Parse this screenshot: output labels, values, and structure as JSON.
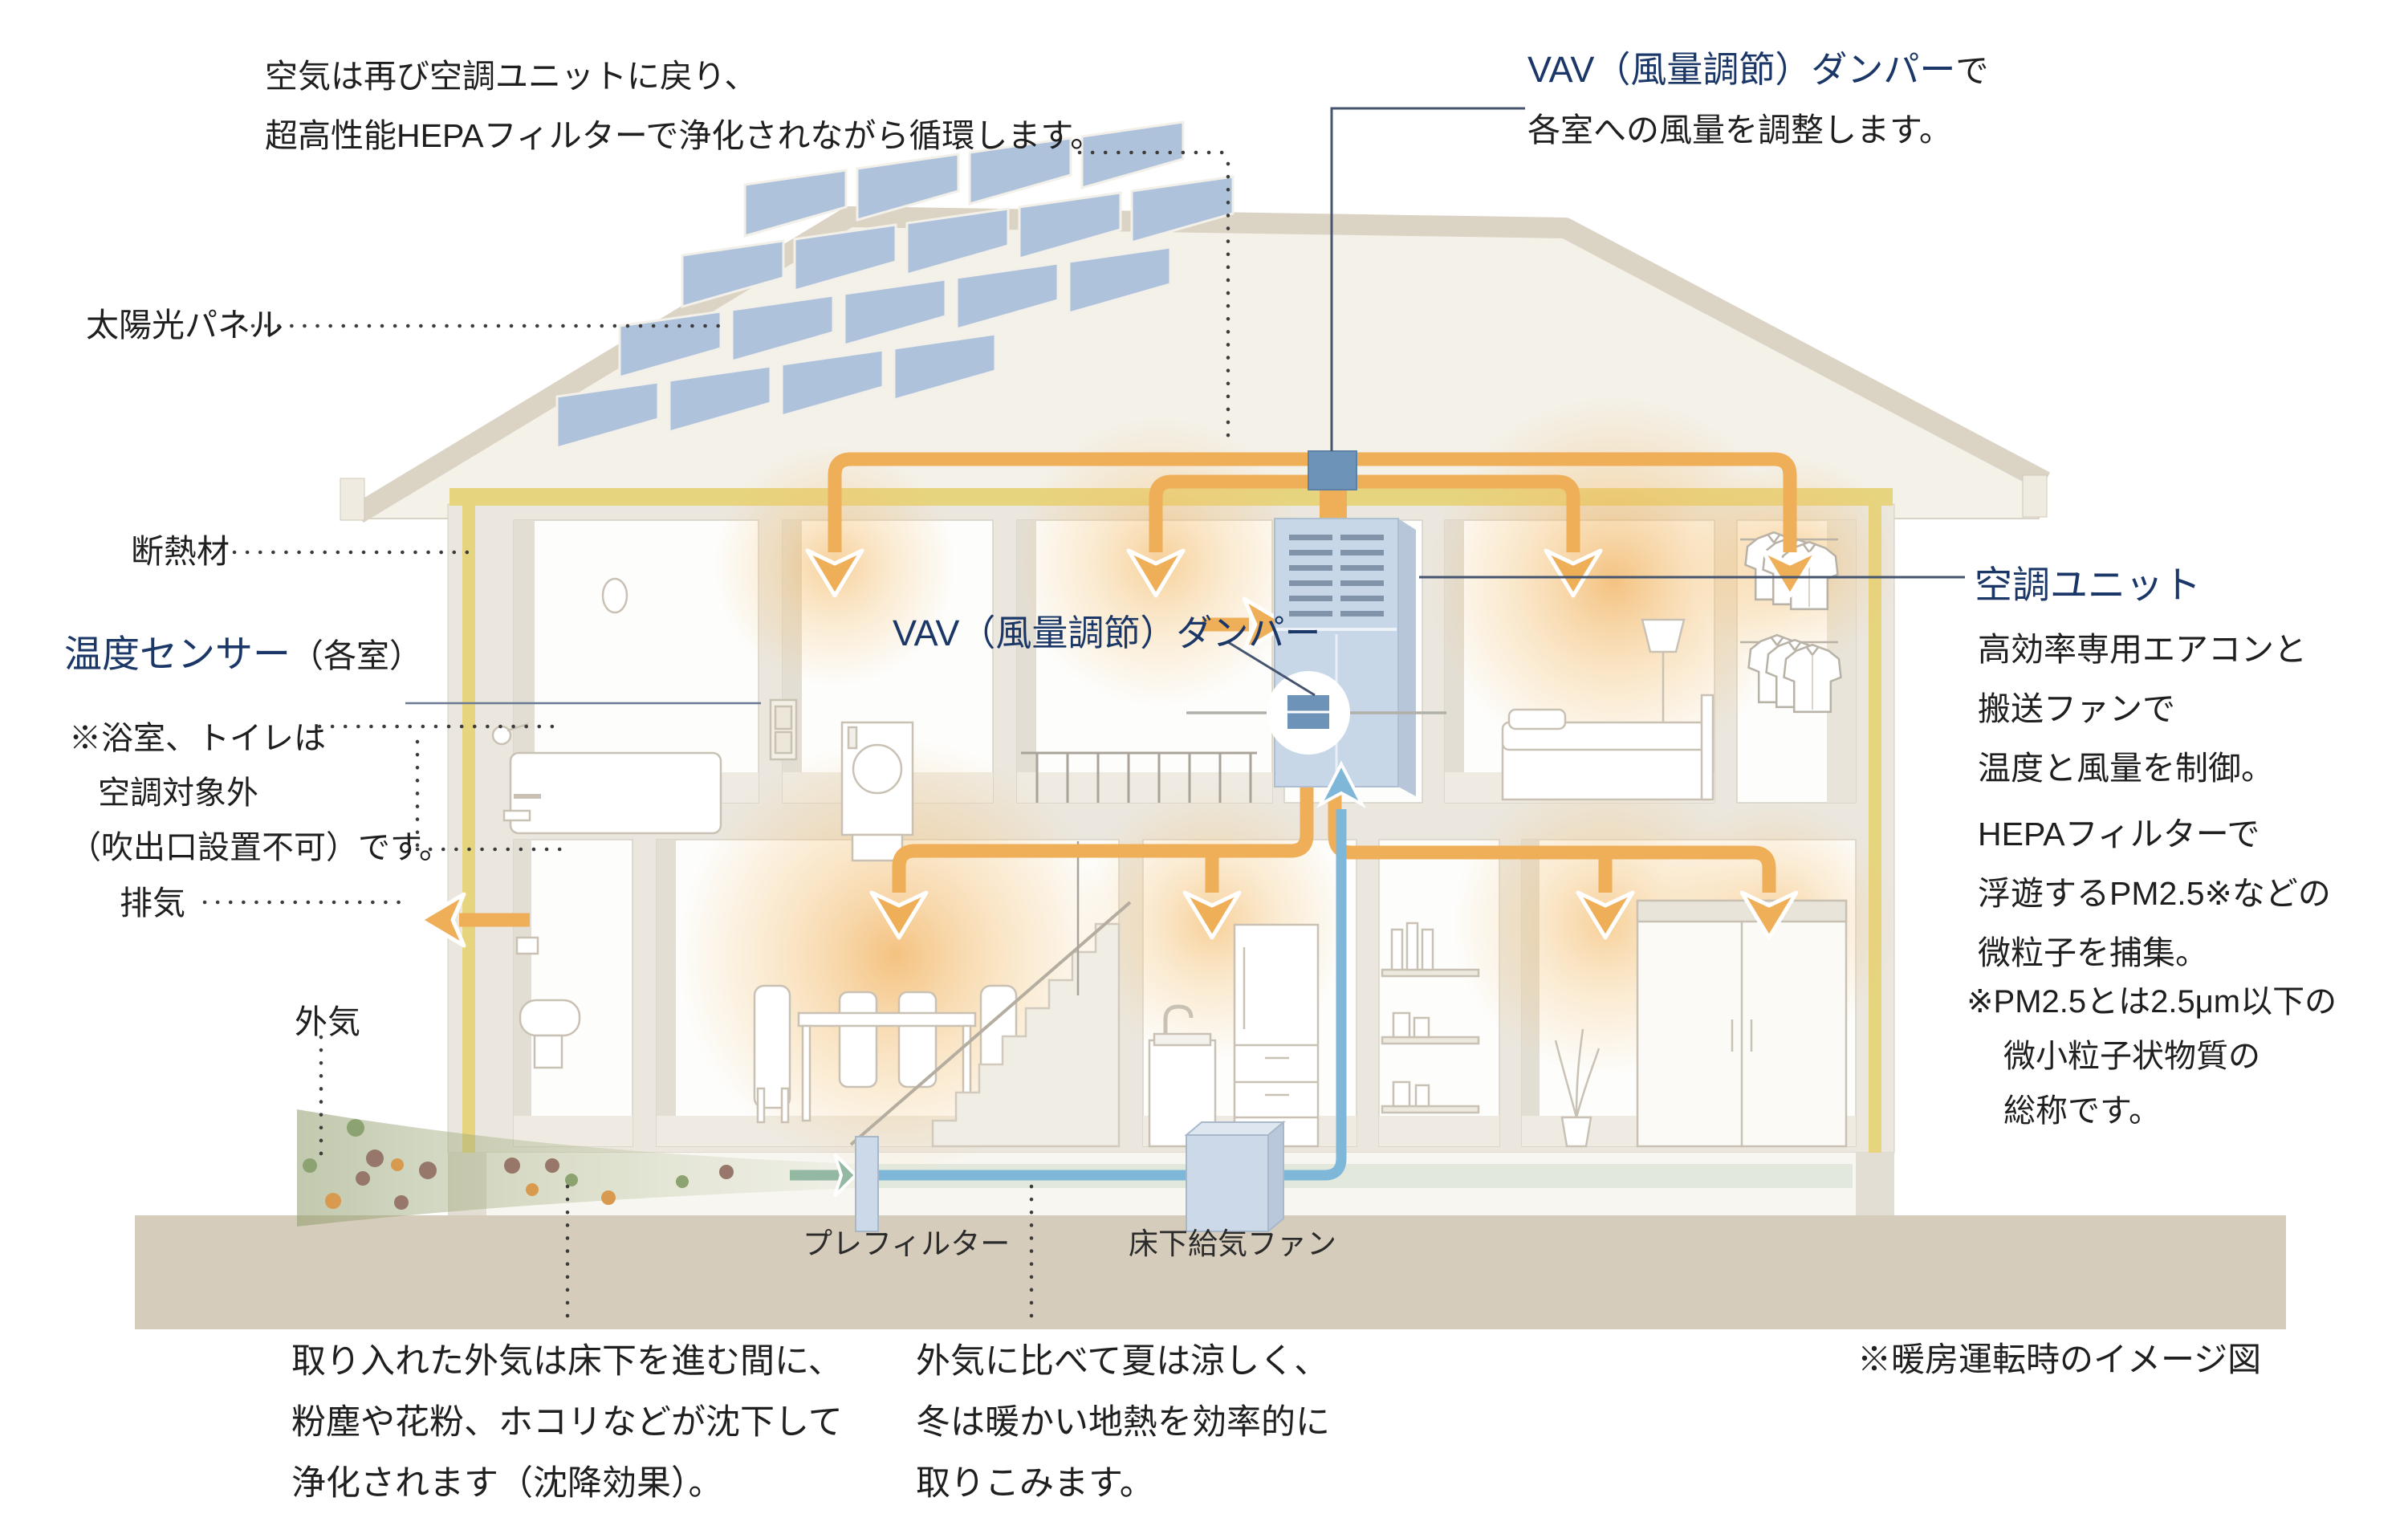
{
  "diagram": {
    "type": "house-hvac-cross-section",
    "note_return": {
      "line1": "空気は再び空調ユニットに戻り、",
      "line2": "超高性能HEPAフィルターで浄化されながら循環します。"
    },
    "vav_top": {
      "name": "VAV（風量調節）ダンパー",
      "suffix": "で",
      "line2": "各室への風量を調整します。"
    },
    "solar_label": "太陽光パネル",
    "insulation_label": "断熱材",
    "temp_sensor": {
      "name": "温度センサー",
      "suffix": "（各室）"
    },
    "bath_note": {
      "line1": "※浴室、トイレは",
      "line2": "空調対象外",
      "line3": "（吹出口設置不可）です。"
    },
    "exhaust_label": "排気",
    "outside_air_label": "外気",
    "vav_center_label": "VAV（風量調節）ダンパー",
    "ac_unit": {
      "title": "空調ユニット",
      "line1": "高効率専用エアコンと",
      "line2": "搬送ファンで",
      "line3": "温度と風量を制御。"
    },
    "hepa": {
      "line1": "HEPAフィルターで",
      "line2": "浮遊するPM2.5※などの",
      "line3": "微粒子を捕集。"
    },
    "pm_note": {
      "line1": "※PM2.5とは2.5μm以下の",
      "line2": "微小粒子状物質の",
      "line3": "総称です。"
    },
    "prefilter_label": "プレフィルター",
    "underfloor_fan_label": "床下給気ファン",
    "underfloor_note": {
      "line1": "取り入れた外気は床下を進む間に、",
      "line2": "粉塵や花粉、ホコリなどが沈下して",
      "line3": "浄化されます（沈降効果）。"
    },
    "geothermal_note": {
      "line1": "外気に比べて夏は涼しく、",
      "line2": "冬は暖かい地熱を効率的に",
      "line3": "取りこみます。"
    },
    "mode_note": "※暖房運転時のイメージ図",
    "colors": {
      "accent_navy": "#1B3767",
      "duct_orange": "#EFAE58",
      "pipe_blue": "#7FB7D9",
      "insulation_yellow": "#E6D47E",
      "ground_tan": "#D6CCBB",
      "unit_blue": "#C8D7E7",
      "damper_blue": "#6E93B8",
      "glow_orange": "#F0A337",
      "stream_green": "#A9B488"
    }
  }
}
